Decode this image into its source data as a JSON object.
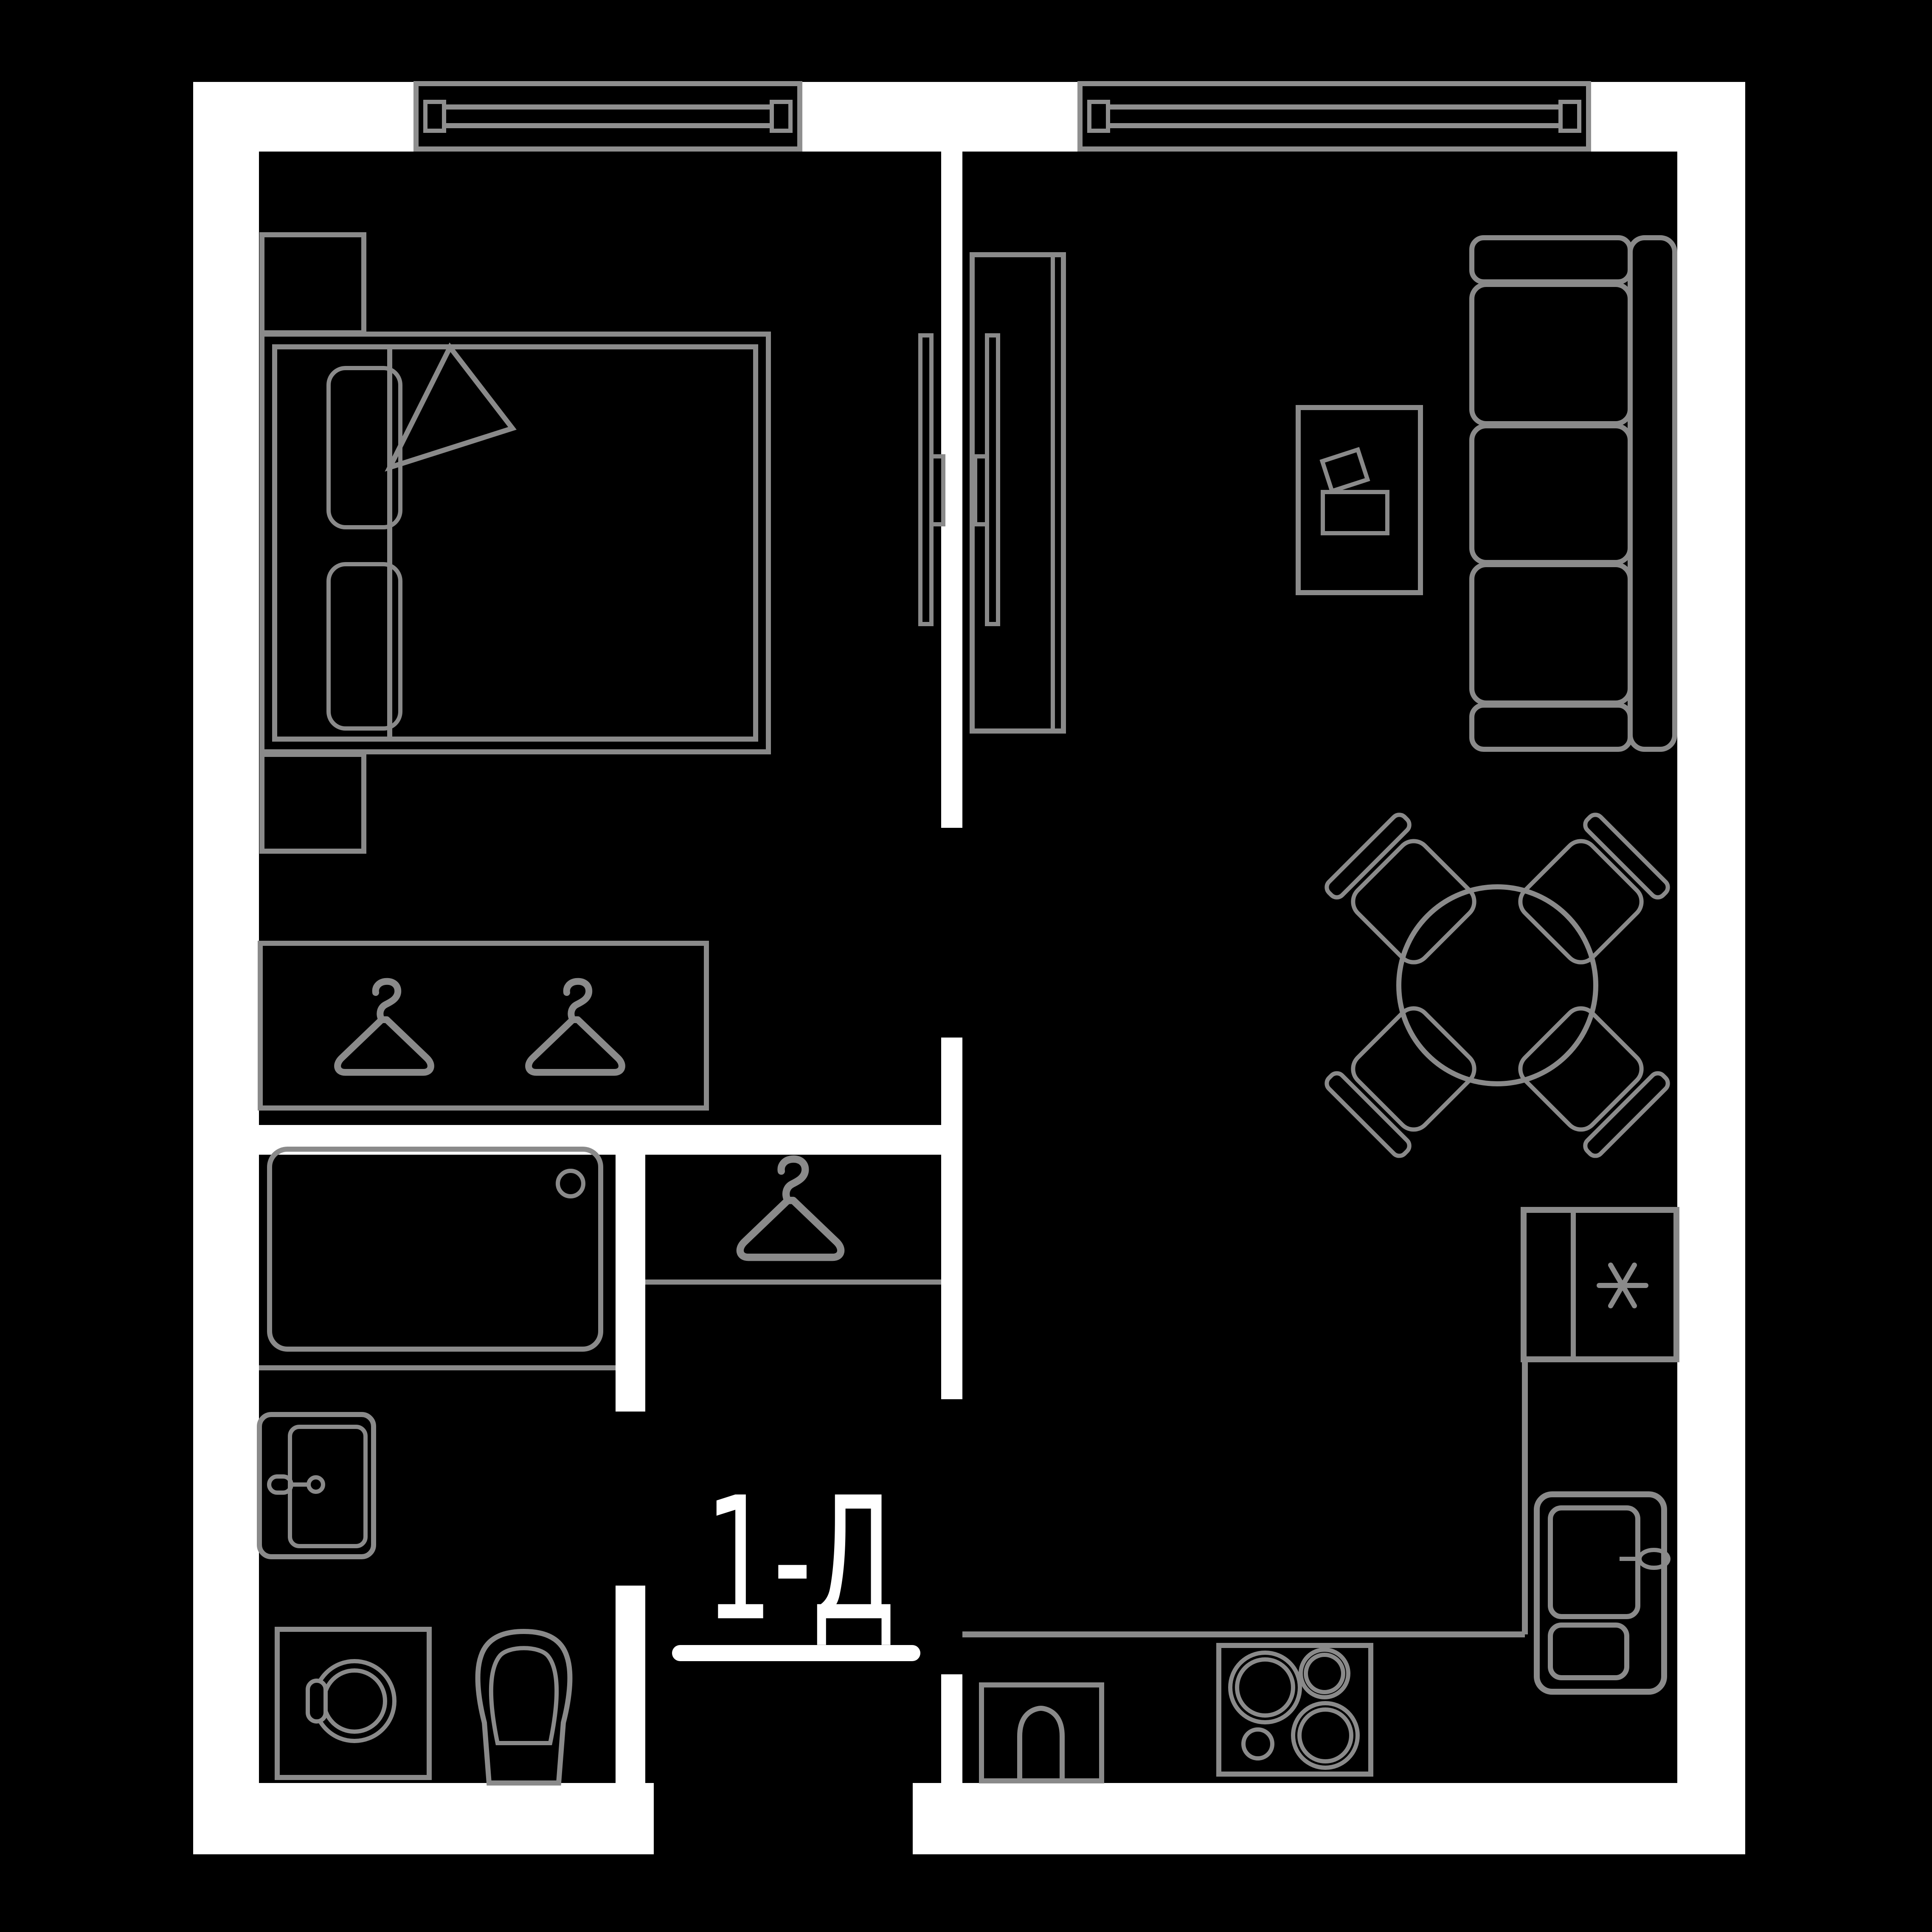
{
  "label": {
    "unit": "1-Д"
  },
  "colors": {
    "background": "#000000",
    "walls": "#ffffff",
    "furniture_outline": "#8a8a8a",
    "window_frame": "#8f8f8f",
    "label_text": "#ffffff"
  },
  "icons": {
    "fridge_marker": "asterisk",
    "wardrobe_marker": "clothes-hanger",
    "closet_marker": "clothes-hanger"
  },
  "plan_symbols": [
    "window",
    "window",
    "double-bed",
    "pillow",
    "pillow",
    "blanket-fold",
    "nightstand",
    "nightstand",
    "wall-tv",
    "wall-tv",
    "tv-cabinet",
    "wardrobe-two-hangers",
    "closet-one-hanger",
    "bathtub",
    "washbasin",
    "washing-machine",
    "toilet",
    "sofa-three-seat",
    "desk-with-laptop",
    "round-dining-table",
    "chair",
    "chair",
    "chair",
    "chair",
    "fridge-freezer",
    "oven",
    "kitchen-sink",
    "cooktop-4-burners"
  ]
}
